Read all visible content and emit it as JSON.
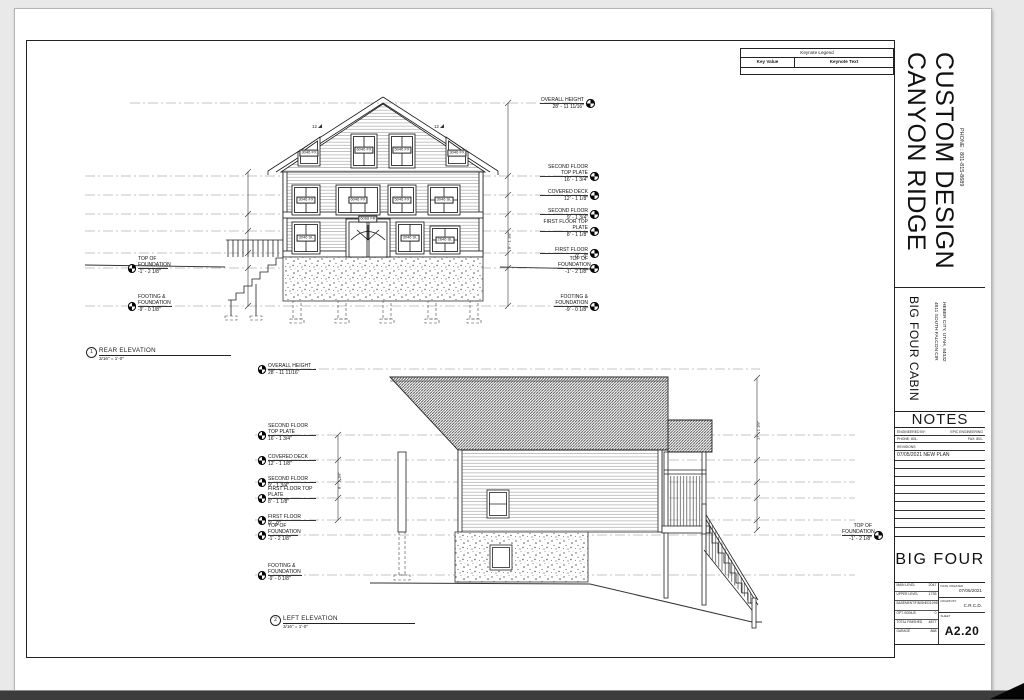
{
  "sheet": {
    "company_line1": "CANYON RIDGE",
    "company_line2": "CUSTOM DESIGN",
    "company_phone": "PHONE : 801-815-8689",
    "project_name": "BIG FOUR CABIN",
    "address_line1": "4811 SOUTH FALCON CIR",
    "address_line2": "HEBER CITY, UTAH, 84032",
    "notes": {
      "title": "NOTES",
      "engineered_by_label": "ENGINEERED BY:",
      "engineered_by_value": "EPIC ENGINEERING",
      "phone_label": "PHONE:  801-",
      "fax_label": "FAX:  801-",
      "revisions_label": "REVISIONS",
      "revision_entry": "07/05/2021 NEW PLAN"
    },
    "project_title": "BIG FOUR",
    "areas": [
      {
        "label": "MAIN LEVEL",
        "value": "2047"
      },
      {
        "label": "UPPER LEVEL",
        "value": "1735"
      },
      {
        "label": "BASEMENT/FINISHED",
        "value": "1095"
      },
      {
        "label": "OPT. BONUS",
        "value": "0"
      },
      {
        "label": "TOTAL FINISHED",
        "value": "4877"
      },
      {
        "label": "GARAGE",
        "value": "868"
      }
    ],
    "stamp": {
      "date_created_label": "DATE CREATED",
      "date_created": "07/05/2021",
      "drawn_by_label": "DRAWN BY",
      "drawn_by": "C.R.C.D.",
      "sheet_label": "SHEET",
      "sheet_number": "A2.20"
    }
  },
  "keynote_legend": {
    "title": "Keynote Legend",
    "key_value_header": "Key Value",
    "keynote_text_header": "Keynote Text"
  },
  "levels": {
    "overall_height": {
      "name": "OVERALL HEIGHT",
      "value": "28' - 11 11/16\""
    },
    "second_floor_top_plate": {
      "name": "SECOND FLOOR TOP PLATE",
      "value": "16' - 1 3/4\""
    },
    "covered_deck": {
      "name": "COVERED DECK",
      "value": "12' - 1 1/8\""
    },
    "second_floor": {
      "name": "SECOND FLOOR",
      "value": "9' - 1 3/4\""
    },
    "first_floor_top_plate": {
      "name": "FIRST FLOOR TOP PLATE",
      "value": "8' - 1 1/8\""
    },
    "first_floor": {
      "name": "FIRST FLOOR",
      "value": "0' - 0\""
    },
    "top_of_foundation": {
      "name": "TOP OF FOUNDATION",
      "value": "-1' - 2 1/8\""
    },
    "footing_foundation": {
      "name": "FOOTING & FOUNDATION",
      "value": "-9' - 0 1/8\""
    }
  },
  "views": [
    {
      "number": "1",
      "name": "REAR ELEVATION",
      "scale": "3/16\" = 1'-0\""
    },
    {
      "number": "2",
      "name": "LEFT ELEVATION",
      "scale": "3/16\" = 1'-0\""
    }
  ],
  "window_tags": [
    "3046 FX",
    "6046 FX",
    "5046 FX",
    "3046 FX",
    "3046 FX",
    "6046 FX",
    "5046 FX",
    "3046 SL",
    "3046 SL",
    "6068 FR",
    "3046 SL",
    "2646 SL"
  ],
  "pitch": "12",
  "dims": {
    "rear_first_story": "8' - 1 1/8\"",
    "left_story": "8' - 1 1/8\"",
    "left_roof": "17' - 1 1/8\""
  }
}
